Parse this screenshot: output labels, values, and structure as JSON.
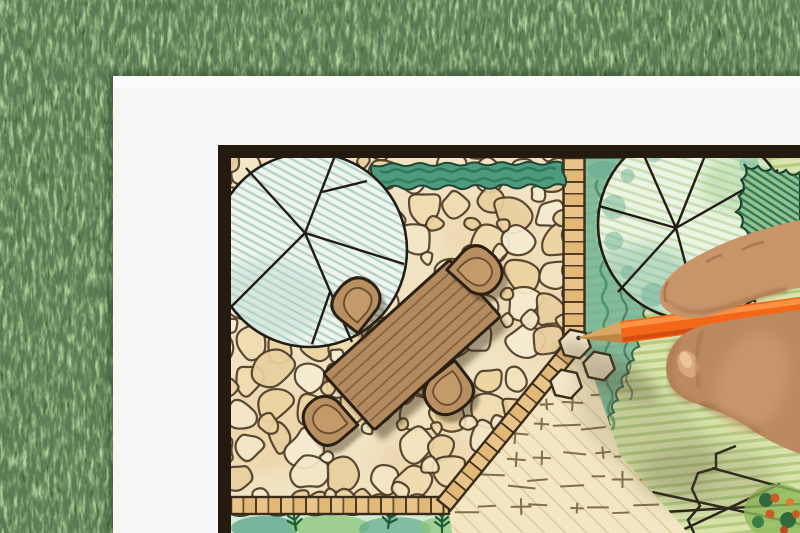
{
  "scene": {
    "description": "Hand holding an orange colored pencil over a hand-drawn landscape architecture garden plan on white paper, lying on green artificial grass",
    "objects": [
      "artificial-grass-background",
      "white-paper-sheet",
      "black-framed-garden-plan",
      "flagstone-patio",
      "tree-canopy-symbols",
      "hedge",
      "lawn",
      "garden-table",
      "garden-chairs",
      "tile-edging",
      "hand",
      "orange-colored-pencil"
    ]
  },
  "furniture": {
    "tables": 1,
    "chairs": 4
  },
  "colors": {
    "grass_base": "#3e6331",
    "paper": "#f6f7f4",
    "frame": "#251a10",
    "patio_base": "#f1e3c2",
    "stone_stroke": "#4e3b27",
    "wash_orange": "#e0aa64",
    "canopy_fill": "#f0f5ef",
    "canopy_hatch": "#a9cdc1",
    "tree_line": "#211c15",
    "hedge_fill": "#4d9a7c",
    "hedge_line": "#1f4636",
    "hedge_scribble": "#276b52",
    "garden_base": "#cfdf9e",
    "lawn_hatch": "#9cbb66",
    "lawn_hatch_lt": "#e6eec6",
    "shrub_teal": "#6fb197",
    "shrub_line": "#1d4a3a",
    "tree2_fill": "#ecf4e3",
    "tree2_hatch": "#b7d49f",
    "darkshrub_fill": "#96c28e",
    "darkshrub_hatch": "#1f6b4e",
    "tile_fill": "#e9c488",
    "tile_alt": "#dcae67",
    "tile_line": "#3a2b1a",
    "bed_fill": "#d8e9d2",
    "bed_teal": "#5fa98c",
    "bed_green": "#8cc57a",
    "fern": "#1e5a34",
    "dash_area": "#f3e6c2",
    "dash_mark": "#6f5a3a",
    "dash_diag": "#dcc491",
    "table_fill": "#b28a5e",
    "table_line": "#2c2014",
    "plank": "#7a5a3a",
    "chair_fill": "#b78f60",
    "chair_seat": "#c39a6a",
    "chair_inner": "#6b4c2e",
    "pencil_body": "#f26718",
    "pencil_hi": "#ff9a4d",
    "pencil_dark": "#c9480f",
    "pencil_wood": "#d8a862",
    "pencil_wood_sh": "#b97f3e",
    "pencil_lead": "#47413b",
    "skin": "#bd8a5f",
    "skin2": "#c89468",
    "skin_shadow": "#96613d",
    "skin_hi": "#dcab7e",
    "nail": "#d9a97c",
    "nail_hi": "#ecc69b",
    "flower_orange": "#cf5a24",
    "flower_orange2": "#d97e2e",
    "flower_green": "#2f6b3d",
    "shadow": "#5f5134",
    "stone_fills": [
      "#f6ecd2",
      "#f2e3bf",
      "#efdcb0",
      "#ecd4a0",
      "#f4e7c8",
      "#e9cf9e"
    ]
  },
  "gen": {
    "stones": {
      "x0": 212,
      "y0": 138,
      "x1": 596,
      "y1": 522,
      "step": 34,
      "rmin": 13,
      "rmax": 21,
      "seed": 7,
      "skip": 0.06
    },
    "smallStones": {
      "prob": 0.55,
      "rmin": 6,
      "rmax": 11
    },
    "dashes": {
      "x0": 436,
      "y0": 346,
      "x1": 706,
      "y1": 533,
      "step": 27,
      "seed": 3
    },
    "ladders": [
      {
        "x": 574,
        "y": 158,
        "len": 196,
        "thick": 21,
        "angle": 90,
        "step": 12
      },
      {
        "x": 231,
        "y": 505.5,
        "len": 218,
        "thick": 17,
        "angle": 0,
        "step": 12.5
      },
      {
        "x": 444,
        "y": 505,
        "len": 202,
        "thick": 17,
        "angle": -50.9,
        "step": 12.5
      }
    ],
    "table": {
      "x": 412,
      "y": 345,
      "rot": -42,
      "w": 170,
      "h": 76
    },
    "chairs": [
      {
        "x": 357,
        "y": 302,
        "rot": -52
      },
      {
        "x": 478,
        "y": 271,
        "rot": 42
      },
      {
        "x": 327,
        "y": 420,
        "rot": -131
      },
      {
        "x": 448,
        "y": 391,
        "rot": 142
      }
    ],
    "ferns": [
      {
        "x": 296,
        "y": 530,
        "rot": -8
      },
      {
        "x": 388,
        "y": 528,
        "rot": 10
      },
      {
        "x": 442,
        "y": 532,
        "rot": 0
      }
    ],
    "hexes": [
      {
        "x": 575,
        "y": 344
      },
      {
        "x": 599,
        "y": 366
      },
      {
        "x": 566,
        "y": 384
      }
    ]
  }
}
